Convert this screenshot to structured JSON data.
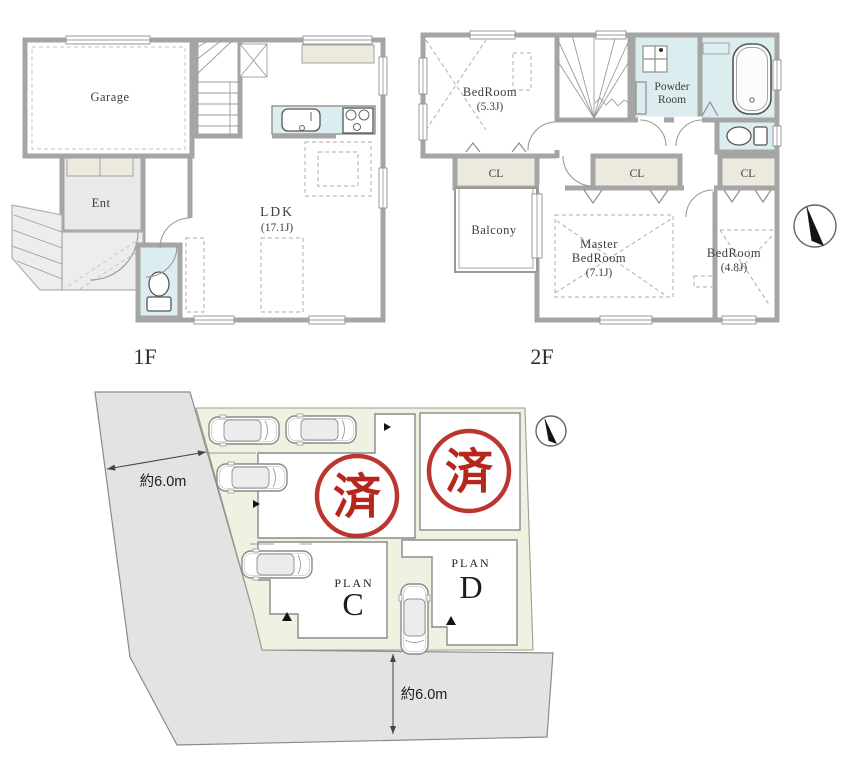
{
  "page": {
    "background": "#ffffff",
    "type": "real-estate floor plan sheet"
  },
  "colors": {
    "wall_gray": "#a5a5a5",
    "water_cyan": "#dcedef",
    "closet_beige": "#ece9df",
    "entrance_gray": "#e9e9e9",
    "site_green": "#edf2e1",
    "road_gray": "#e3e3e3",
    "stamp_red": "#b5261d",
    "label_dark": "#3d3d3d"
  },
  "floor1": {
    "label": "1F",
    "rooms": {
      "garage": "Garage",
      "entrance": "Ent",
      "ldk": "LDK",
      "ldk_size": "(17.1J)"
    }
  },
  "floor2": {
    "label": "2F",
    "rooms": {
      "bedroom1": "BedRoom",
      "bedroom1_size": "(5.3J)",
      "powder_line1": "Powder",
      "powder_line2": "Room",
      "closet": "CL",
      "balcony": "Balcony",
      "master_line1": "Master",
      "master_line2": "BedRoom",
      "master_size": "(7.1J)",
      "bedroom2": "BedRoom",
      "bedroom2_size": "(4.8J)"
    }
  },
  "site_plan": {
    "sold_stamp": "済",
    "plan_label": "PLAN",
    "plan_c": "C",
    "plan_d": "D",
    "road_width_west": "約6.0m",
    "road_width_south": "約6.0m"
  }
}
